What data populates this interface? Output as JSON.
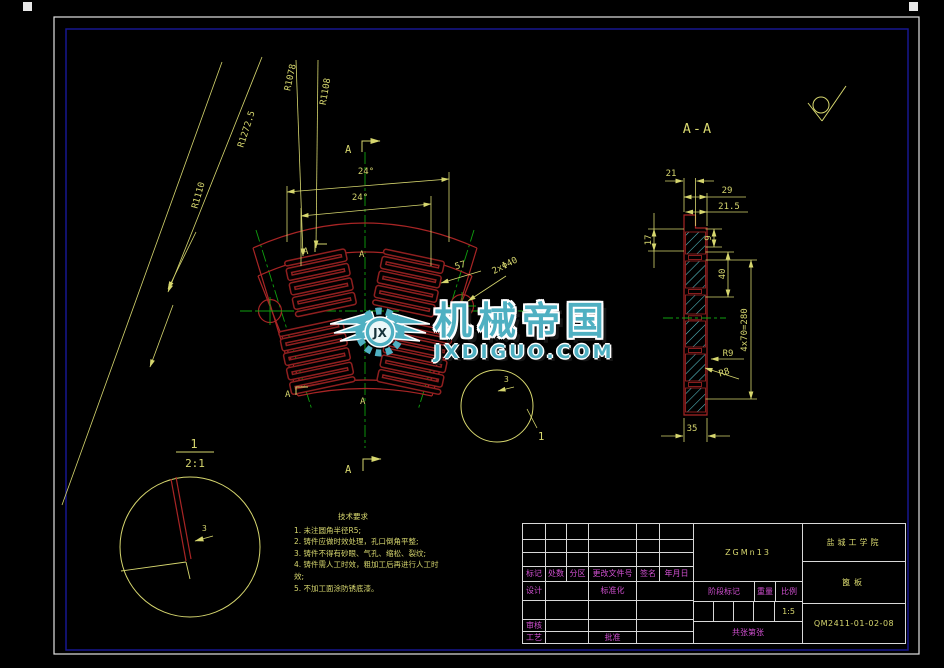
{
  "watermark": {
    "brand": "机械帝国",
    "domain": "JXDIGUO.COM",
    "monogram": "JX",
    "color": "#4fb0c2"
  },
  "main_view": {
    "r_outer": "R1272.5",
    "r_1078": "R1078",
    "r_1108": "R1108",
    "r_1110": "R1110",
    "angle_top": "24°",
    "angle_inner": "24°",
    "section_letter": "A",
    "d57": "57",
    "holes": "2xΦ40",
    "balloon": "1",
    "d3": "3"
  },
  "detail_view": {
    "num": "1",
    "scale": "2:1",
    "d3": "3"
  },
  "section_view": {
    "title": "A-A",
    "d21": "21",
    "d29": "29",
    "d215": "21.5",
    "d17": "17",
    "d9": "9",
    "d40": "40",
    "pitch": "4x70=280",
    "r9": "R9",
    "r8": "R8",
    "d35": "35"
  },
  "notes": {
    "title": "技术要求",
    "items": [
      "1. 未注圆角半径R5;",
      "2. 铸件应做时效处理，孔口倒角平整;",
      "3. 铸件不得有砂眼、气孔、缩松、裂纹;",
      "4. 铸件需人工时效，粗加工后再进行人工时效;",
      "5. 不加工面涂防锈底漆。"
    ]
  },
  "title_block": {
    "material": "ZGMn13",
    "school": "盐城工学院",
    "part": "篦板",
    "drawing_no": "QM2411-01-02-08",
    "scale_value": "1:5",
    "labels": {
      "mark": "标记",
      "count": "处数",
      "zone": "分区",
      "doc_no": "更改文件号",
      "sign": "签名",
      "date": "年月日",
      "design": "设计",
      "standard": "标准化",
      "check": "审核",
      "process": "工艺",
      "approve": "批准",
      "stage": "阶段标记",
      "weight": "重量",
      "scale": "比例",
      "total": "共",
      "sheets": "张",
      "no": "第",
      "sheet": "张"
    }
  },
  "colors": {
    "dim_yellow": "#d6d66e",
    "geometry_red": "#a82525",
    "centerline_green": "#0fa00f",
    "hatch_cyan": "#5ac4cc",
    "label_magenta": "#cf4fcf",
    "frame_white": "#e2e2e2",
    "frame_blue": "#17178f",
    "watermark_teal": "#4fb0c2"
  }
}
